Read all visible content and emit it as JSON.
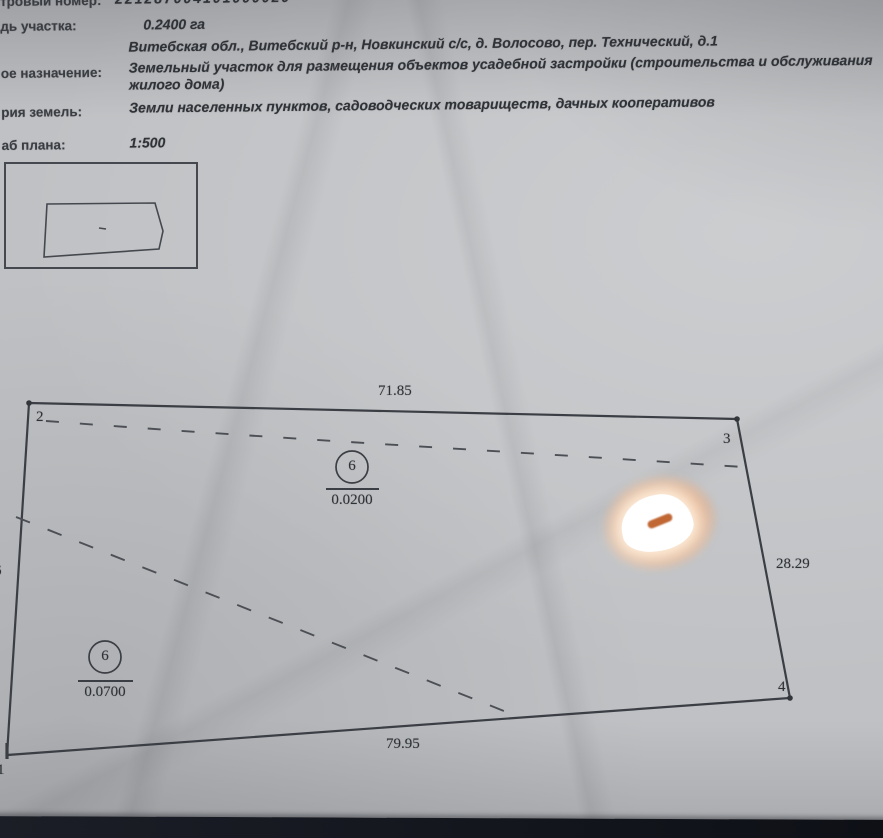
{
  "document": {
    "fields": {
      "cadastral": {
        "label": "тровый номер:",
        "value": "221287004101000020"
      },
      "area": {
        "label": "дь участка:",
        "value": "0.2400  га"
      },
      "address": {
        "label": "",
        "value": "Витебская обл., Витебский р-н, Новкинский с/с, д. Волосово, пер. Технический, д.1"
      },
      "purpose": {
        "label": "ое назначение:",
        "value": "Земельный участок для размещения объектов усадебной застройки (строительства и обслуживания жилого дома)"
      },
      "category": {
        "label": "рия земель:",
        "value": "Земли населенных пунктов, садоводческих товариществ, дачных кооперативов"
      },
      "scale": {
        "label": "аб плана:",
        "value": "1:500"
      }
    }
  },
  "plan": {
    "dim_top": "71.85",
    "dim_right": "28.29",
    "dim_bottom": "79.95",
    "dim_left_partial": "6",
    "corner_top_left": "2",
    "corner_top_right": "3",
    "corner_bottom_right": "4",
    "corner_bottom_left": "1",
    "zone_a": {
      "code": "6",
      "area": "0.0200"
    },
    "zone_b": {
      "code": "6",
      "area": "0.0700"
    }
  },
  "colors": {
    "paper": "#bfc1c4",
    "ink": "#3b3e44",
    "glare_halo": "#f29656",
    "bottom_bar": "#14161e"
  }
}
